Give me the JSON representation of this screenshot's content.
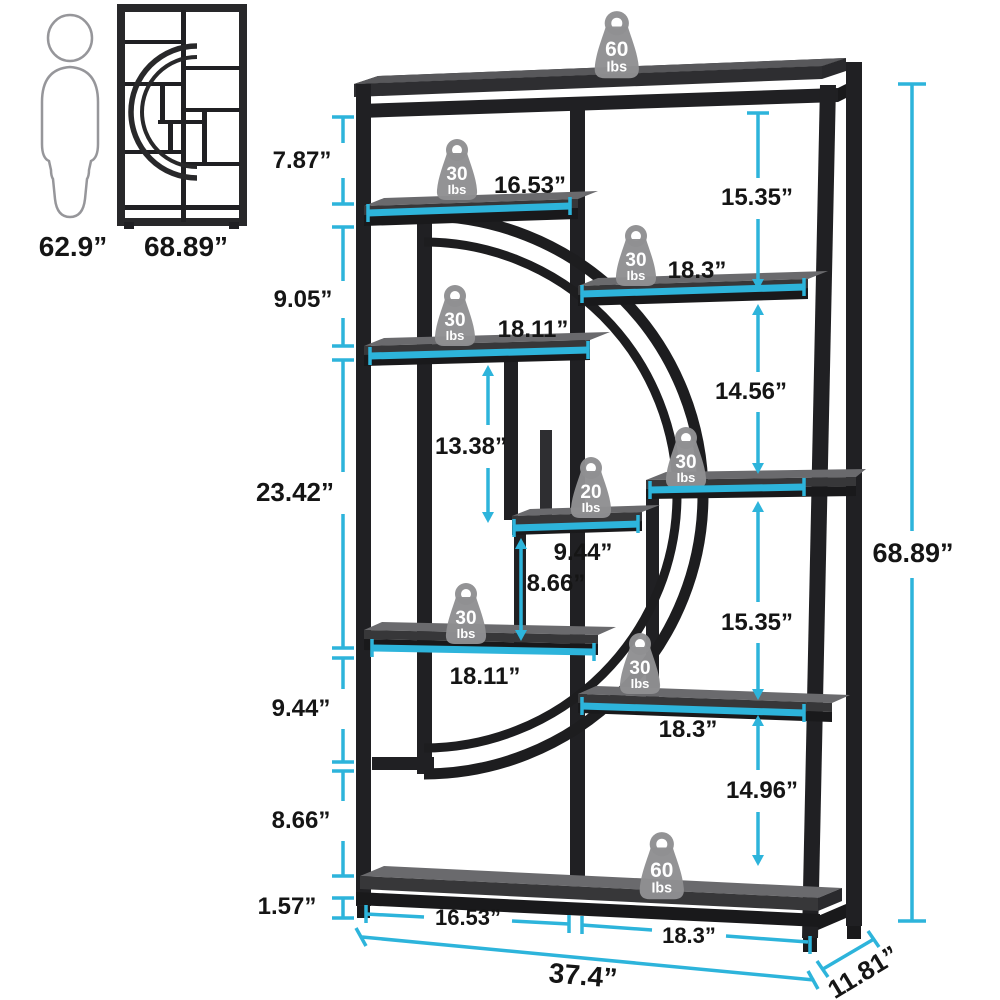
{
  "reference": {
    "person_height": "62.9”",
    "unit_height": "68.89”"
  },
  "dims": {
    "left": [
      "7.87”",
      "9.05”",
      "23.42”",
      "9.44”",
      "8.66”",
      "1.57”"
    ],
    "right_inner": [
      "15.35”",
      "14.56”",
      "15.35”",
      "14.96”"
    ],
    "inner_vertical": {
      "clearance": "13.38”",
      "middle_gap": "8.66”"
    },
    "shelf_spans": {
      "top_left": "16.53”",
      "right_upper": "18.3”",
      "left_mid": "18.11”",
      "middle": "9.44”",
      "left_lower": "18.11”",
      "right_lower": "18.3”",
      "bottom_left": "16.53”",
      "bottom_right": "18.3”"
    },
    "total_height": "68.89”",
    "total_width": "37.4”",
    "depth": "11.81”"
  },
  "badges": {
    "unit": "Ibs",
    "items": [
      {
        "id": "top",
        "value": "60"
      },
      {
        "id": "shelf-top-left",
        "value": "30"
      },
      {
        "id": "shelf-right-upper",
        "value": "30"
      },
      {
        "id": "shelf-left-mid",
        "value": "30"
      },
      {
        "id": "shelf-right-mid",
        "value": "30"
      },
      {
        "id": "shelf-middle",
        "value": "20"
      },
      {
        "id": "shelf-left-lower",
        "value": "30"
      },
      {
        "id": "shelf-right-lower",
        "value": "30"
      },
      {
        "id": "bottom",
        "value": "60"
      }
    ]
  },
  "colors": {
    "accent": "#2db4db",
    "frame": "#202023",
    "board_top": "#6a6a6d",
    "board_front": "#373739",
    "badge": "#8f8f92",
    "text": "#151515"
  }
}
